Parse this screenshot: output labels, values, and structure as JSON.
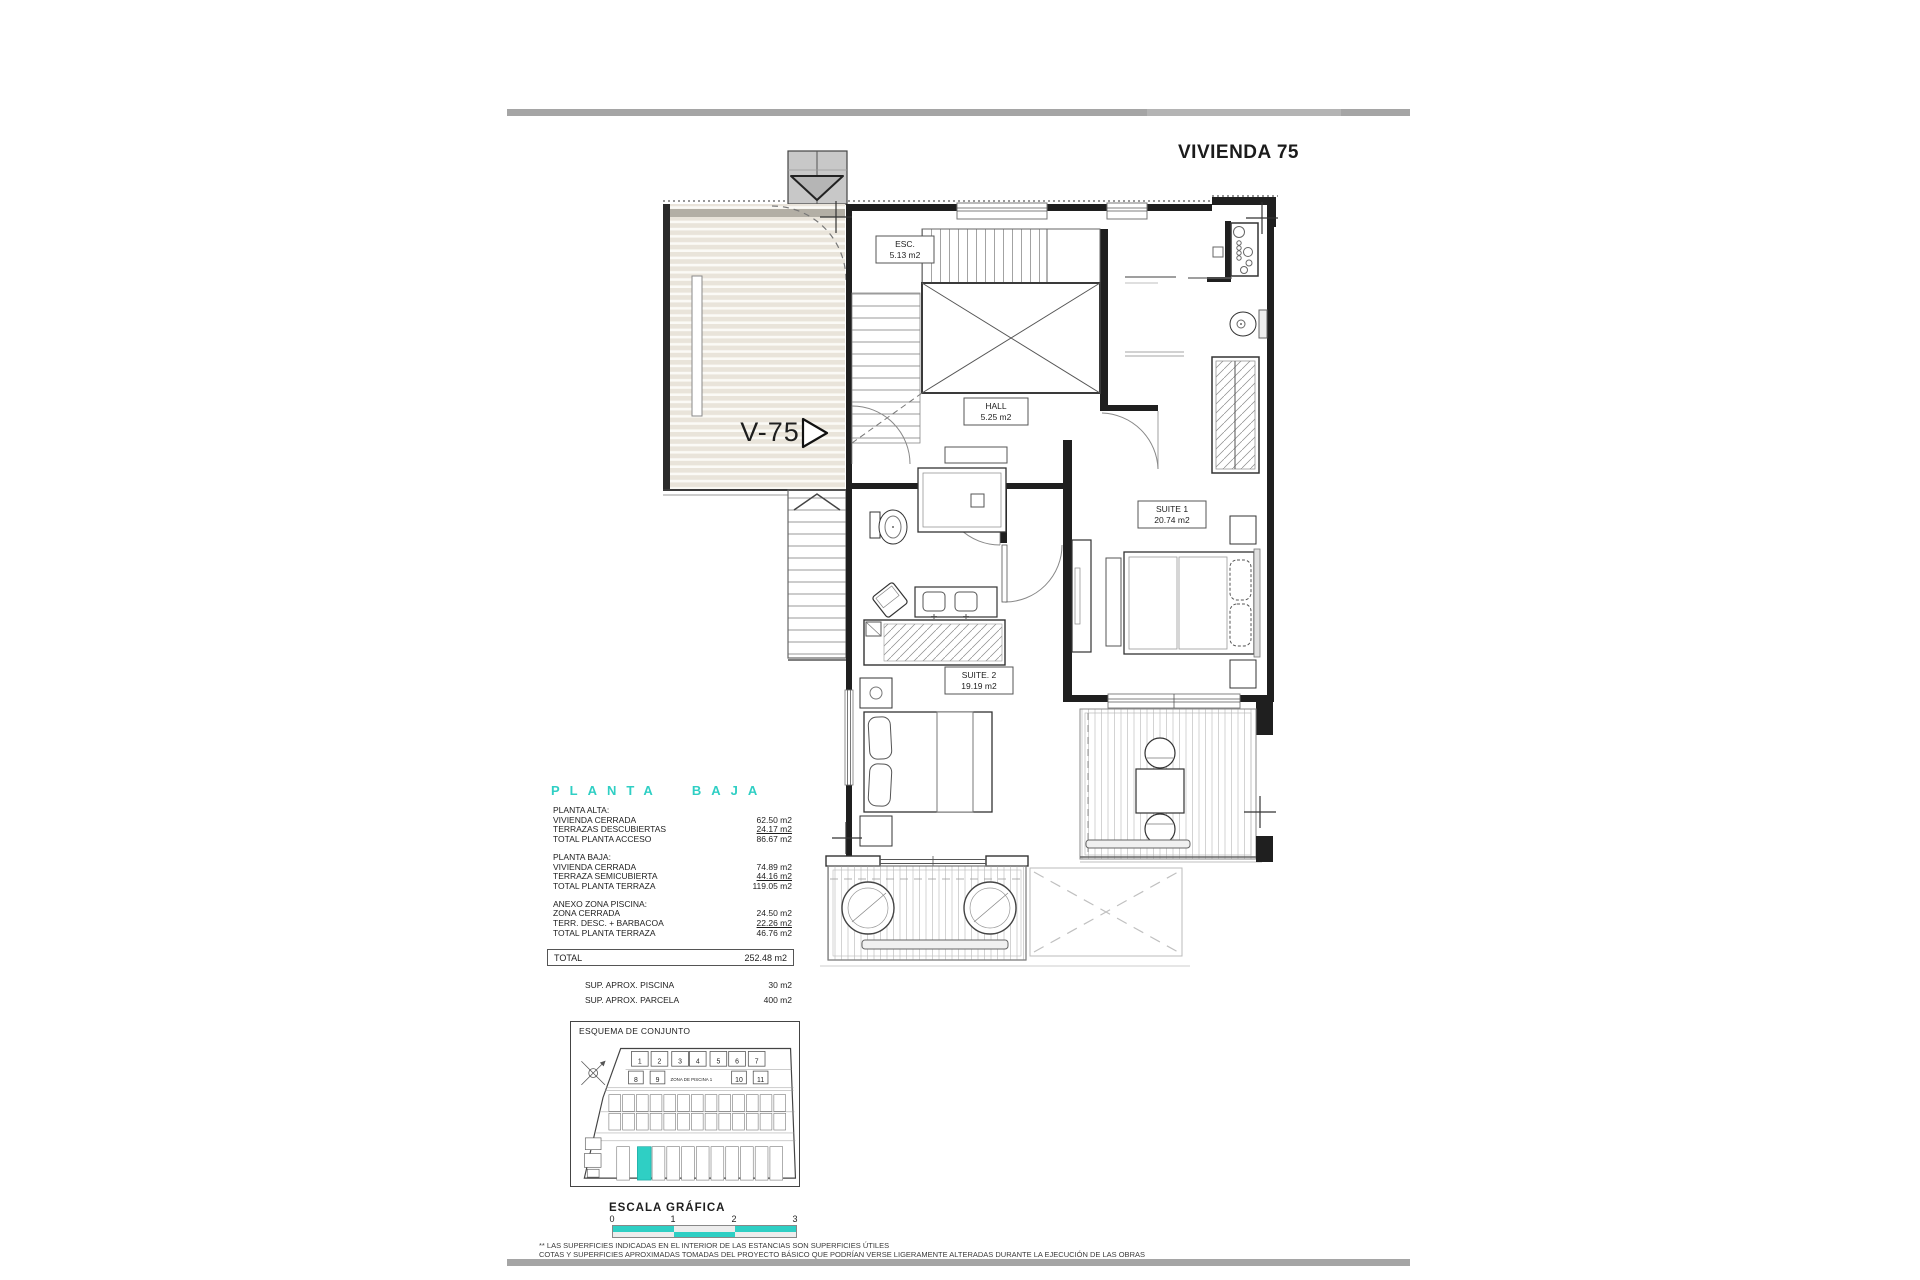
{
  "sheet": {
    "title": "VIVIENDA 75",
    "footnote_1": "** LAS SUPERFICIES INDICADAS EN EL INTERIOR DE LAS ESTANCIAS SON SUPERFICIES ÚTILES",
    "footnote_2": "COTAS Y SUPERFICIES APROXIMADAS TOMADAS DEL PROYECTO BÁSICO QUE PODRÍAN VERSE LIGERAMENTE ALTERADAS DURANTE LA EJECUCIÓN DE LAS OBRAS"
  },
  "plan": {
    "unit_label": "V-75",
    "rooms": [
      {
        "name": "ESC.",
        "area": "5.13 m2"
      },
      {
        "name": "HALL",
        "area": "5.25 m2"
      },
      {
        "name": "SUITE 1",
        "area": "20.74 m2"
      },
      {
        "name": "SUITE. 2",
        "area": "19.19 m2"
      }
    ]
  },
  "areas": {
    "heading": "PLANTA BAJA",
    "groups": [
      {
        "title": "PLANTA ALTA:",
        "rows": [
          {
            "label": "VIVIENDA CERRADA",
            "value": "62.50 m2"
          },
          {
            "label": "TERRAZAS DESCUBIERTAS",
            "value": "24.17 m2"
          },
          {
            "label": "TOTAL PLANTA ACCESO",
            "value": "86.67 m2"
          }
        ]
      },
      {
        "title": "PLANTA BAJA:",
        "rows": [
          {
            "label": "VIVIENDA CERRADA",
            "value": "74.89 m2"
          },
          {
            "label": "TERRAZA SEMICUBIERTA",
            "value": "44.16 m2"
          },
          {
            "label": "TOTAL PLANTA TERRAZA",
            "value": "119.05 m2"
          }
        ]
      },
      {
        "title": "ANEXO ZONA PISCINA:",
        "rows": [
          {
            "label": "ZONA CERRADA",
            "value": "24.50 m2"
          },
          {
            "label": "TERR. DESC. + BARBACOA",
            "value": "22.26 m2"
          },
          {
            "label": "TOTAL PLANTA TERRAZA",
            "value": "46.76 m2"
          }
        ]
      }
    ],
    "total": {
      "label": "TOTAL",
      "value": "252.48 m2"
    },
    "extras": [
      {
        "label": "SUP.  APROX. PISCINA",
        "value": "30 m2"
      },
      {
        "label": "SUP.  APROX. PARCELA",
        "value": "400 m2"
      }
    ]
  },
  "site_plan": {
    "title": "ESQUEMA DE CONJUNTO",
    "zone_label": "ZONA DE PISCINA 1",
    "unit_labels": [
      "1",
      "2",
      "3",
      "4",
      "5",
      "6",
      "7",
      "8",
      "9",
      "10",
      "11"
    ]
  },
  "scale_bar": {
    "title": "ESCALA GRÁFICA",
    "ticks": [
      "0",
      "1",
      "2",
      "3"
    ]
  },
  "colors": {
    "accent_teal": "#2fcfc4",
    "terrace_fill": "#e9e4da",
    "rule_gray": "#a5a5a5"
  }
}
